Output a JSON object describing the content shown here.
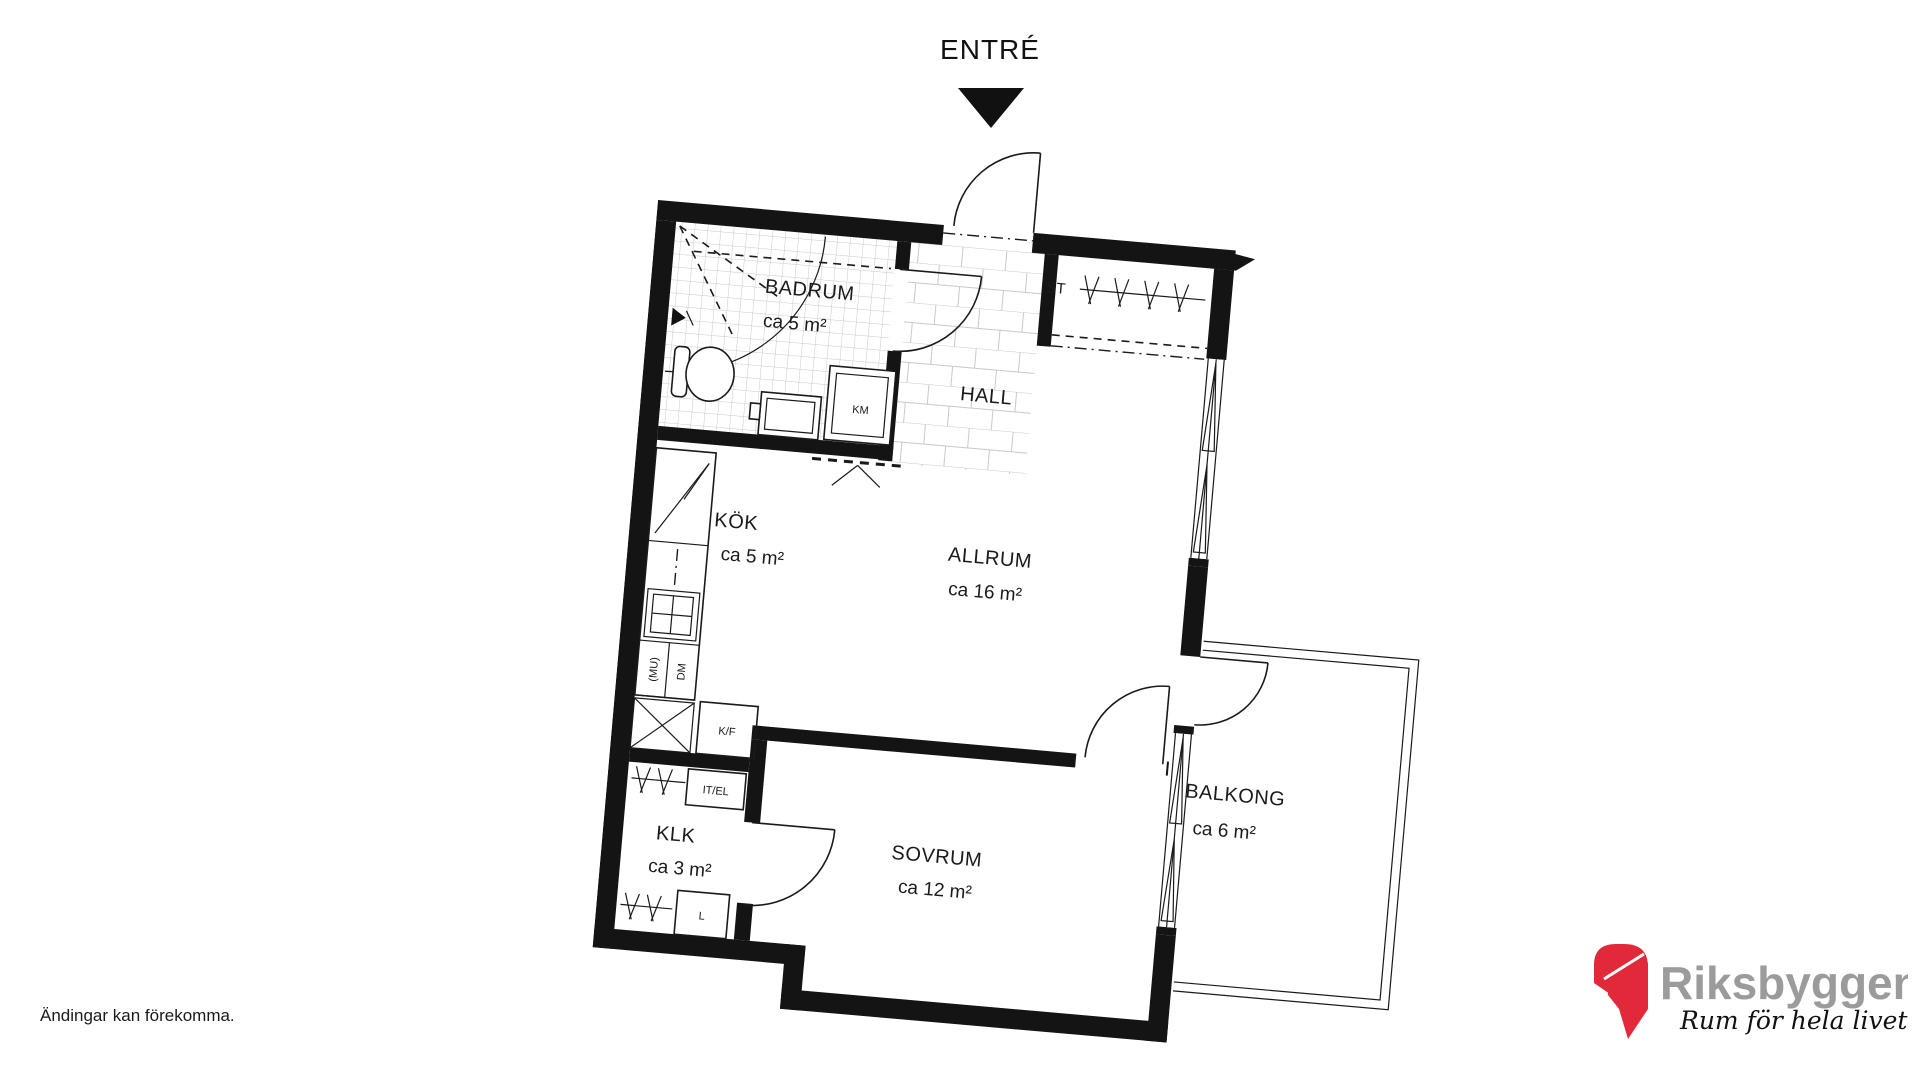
{
  "entry": {
    "label": "ENTRÉ"
  },
  "rooms": {
    "badrum": {
      "name": "BADRUM",
      "area": "ca 5 m²"
    },
    "hall": {
      "name": "HALL"
    },
    "st": {
      "label": "ST"
    },
    "kok": {
      "name": "KÖK",
      "area": "ca 5 m²"
    },
    "allrum": {
      "name": "ALLRUM",
      "area": "ca 16 m²"
    },
    "klk": {
      "name": "KLK",
      "area": "ca 3 m²"
    },
    "sovrum": {
      "name": "SOVRUM",
      "area": "ca 12 m²"
    },
    "balkong": {
      "name": "BALKONG",
      "area": "ca 6 m²"
    }
  },
  "fixtures": {
    "km": "KM",
    "kf": "K/F",
    "itel": "IT/EL",
    "l": "L",
    "mu": "(MU)",
    "dm": "DM"
  },
  "footer": {
    "disclaimer": "Ändingar kan förekomma."
  },
  "logo": {
    "brand": "Riksbyggen",
    "tagline": "Rum för hela livet",
    "red": "#e2293a",
    "gray": "#9b9b9b"
  },
  "colors": {
    "line": "#1a1a1a",
    "tile_line": "#c9c9c9"
  }
}
